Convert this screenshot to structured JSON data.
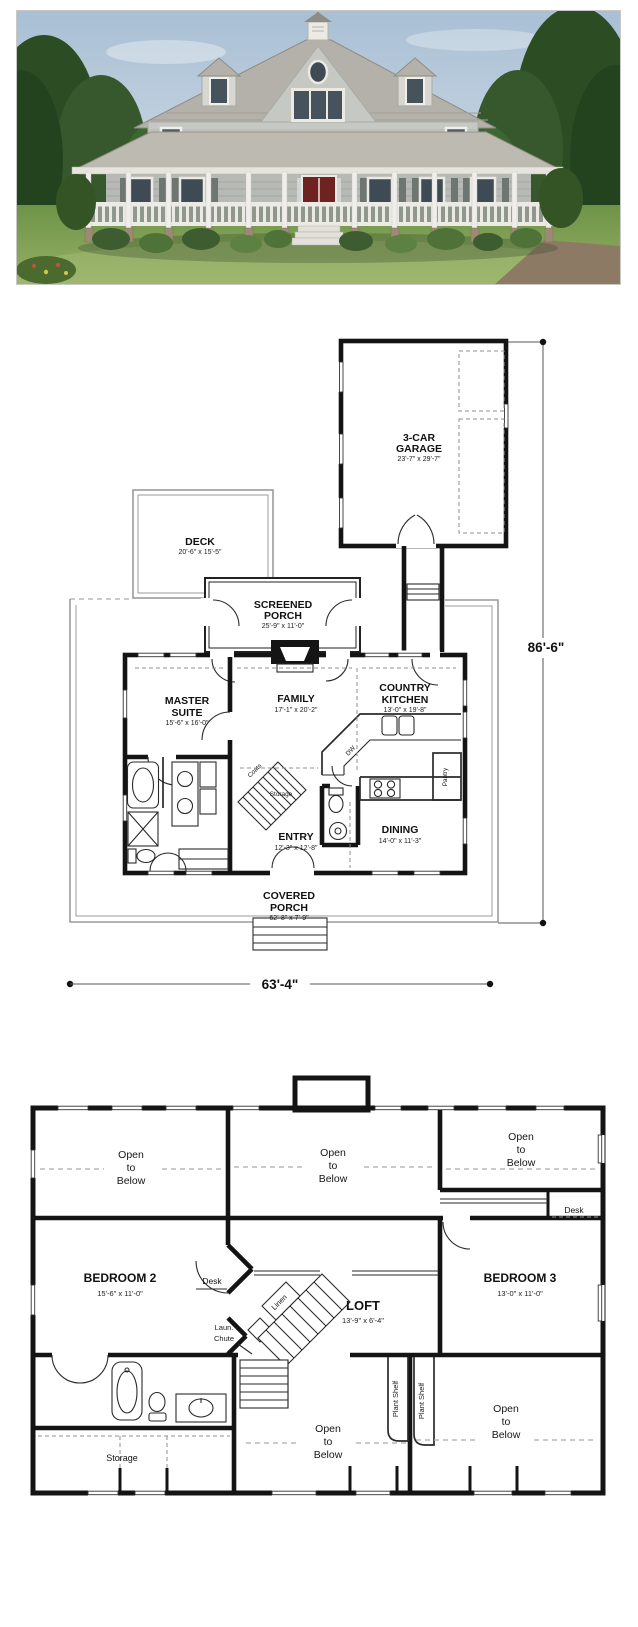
{
  "photo": {
    "description": "Two-story gray country farmhouse with wraparound porch, center front gable, two dormers, cupola and red double front door on a landscaped green lawn"
  },
  "first_floor": {
    "garage": {
      "line1": "3-CAR",
      "line2": "GARAGE",
      "dims": "23'-7\" x 29'-7\""
    },
    "deck": {
      "line1": "DECK",
      "dims": "20'-6\" x 15'-5\""
    },
    "screened_porch": {
      "line1": "SCREENED",
      "line2": "PORCH",
      "dims": "25'-9\" x 11'-0\""
    },
    "master_suite": {
      "line1": "MASTER",
      "line2": "SUITE",
      "dims": "15'-6\" x 16'-0\""
    },
    "family": {
      "line1": "FAMILY",
      "dims": "17'-1\" x 20'-2\""
    },
    "country_kitchen": {
      "line1": "COUNTRY",
      "line2": "KITCHEN",
      "dims": "13'-0\" x 19'-8\""
    },
    "entry": {
      "line1": "ENTRY",
      "dims": "12'-3\" x 12'-8\""
    },
    "dining": {
      "line1": "DINING",
      "dims": "14'-0\" x 11'-3\""
    },
    "covered_porch": {
      "line1": "COVERED",
      "line2": "PORCH",
      "dims": "62'-8\" x 7'-9\""
    },
    "storage_label": "Storage",
    "coats_label": "Coats",
    "pantry_label": "Pantry",
    "dw_label": "DW",
    "overall_depth": "86'-6\"",
    "overall_width": "63'-4\""
  },
  "second_floor": {
    "bedroom2": {
      "line1": "BEDROOM 2",
      "dims": "15'-6\" x 11'-0\""
    },
    "bedroom3": {
      "line1": "BEDROOM 3",
      "dims": "13'-0\" x 11'-0\""
    },
    "loft": {
      "line1": "LOFT",
      "dims": "13'-9\" x 6'-4\""
    },
    "open_to_below": {
      "line1": "Open",
      "line2": "to",
      "line3": "Below"
    },
    "desk_label": "Desk",
    "laundry_chute": {
      "line1": "Laun.",
      "line2": "Chute"
    },
    "linen_label": "Linen",
    "plant_shelf_label": "Plant Shelf",
    "storage_label": "Storage"
  }
}
